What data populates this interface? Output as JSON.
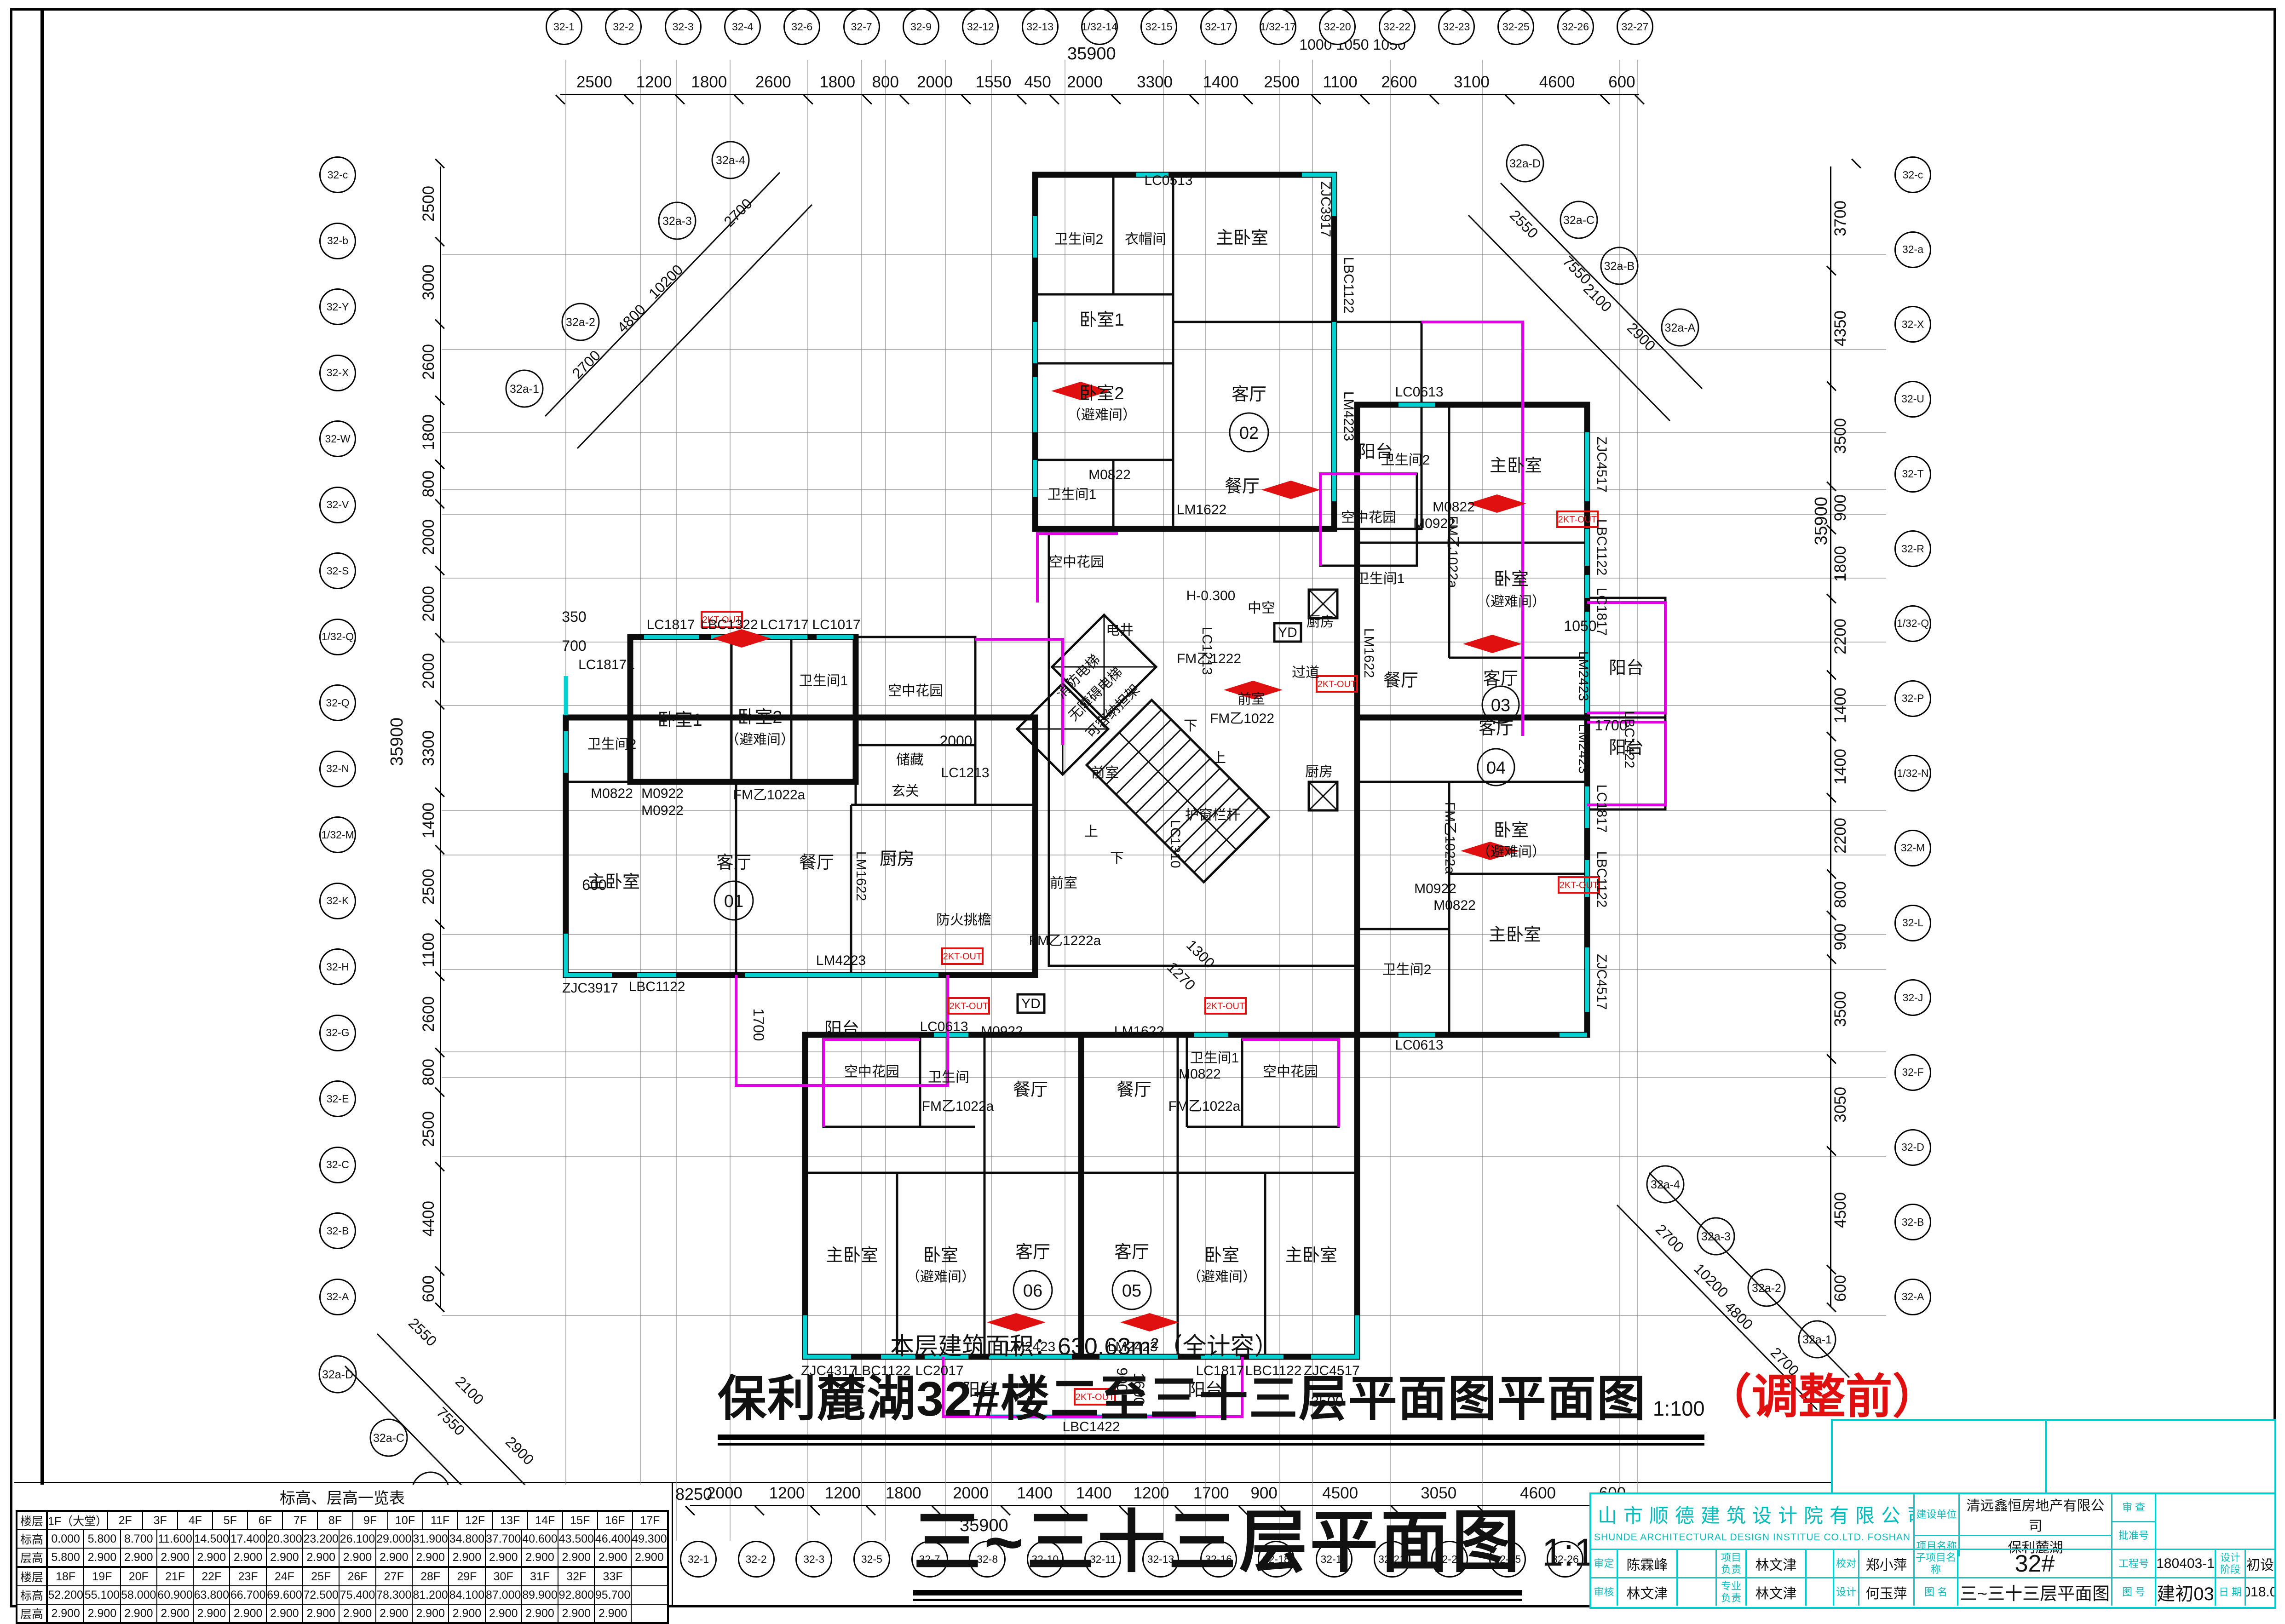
{
  "sheet": {
    "area_note": "本层建筑面积：630.63m²（全计容）",
    "main_title": "保利麓湖32#楼二至三十三层平面图平面图",
    "main_scale": "1:100",
    "revision_note": "（调整前）",
    "drawing_title": "三~三十三层平面图",
    "drawing_scale": "1:100"
  },
  "dims": {
    "top": {
      "total": "35900",
      "segs": [
        "2500",
        "1200",
        "1800",
        "2600",
        "1800",
        "800",
        "2000",
        "1550",
        "450",
        "2000",
        "3300",
        "1400",
        "2500",
        "1100",
        "2600",
        "3100",
        "4600",
        "600"
      ]
    },
    "bottom": {
      "total": "35900",
      "left_note": "8250",
      "segs": [
        "2000",
        "1200",
        "1200",
        "1800",
        "2000",
        "1400",
        "1400",
        "1200",
        "1700",
        "900",
        "4500",
        "3050",
        "4600",
        "600"
      ]
    },
    "left": {
      "total": "35900",
      "segs": [
        "2500",
        "3000",
        "2600",
        "1800",
        "800",
        "2000",
        "2000",
        "2000",
        "3300",
        "1400",
        "2500",
        "1100",
        "2600",
        "800",
        "2500",
        "4400",
        "600"
      ]
    },
    "right": {
      "total": "35900",
      "segs": [
        "3700",
        "4350",
        "3500",
        "900",
        "1800",
        "2200",
        "1400",
        "1400",
        "2200",
        "800",
        "900",
        "3500",
        "3050",
        "4500",
        "600"
      ]
    }
  },
  "axes": {
    "top": [
      "32-1",
      "32-2",
      "32-3",
      "32-4",
      "32-6",
      "32-7",
      "32-9",
      "32-12",
      "32-13",
      "1/32-14",
      "32-15",
      "32-17",
      "1/32-17",
      "32-20",
      "32-22",
      "32-23",
      "32-25",
      "32-26",
      "32-27"
    ],
    "bottom": [
      "32-1",
      "32-2",
      "32-3",
      "32-5",
      "32-7",
      "32-8",
      "32-10",
      "32-11",
      "32-13",
      "32-16",
      "32-18",
      "32-19",
      "32-21",
      "32-24",
      "32-25",
      "32-26",
      "32-27"
    ],
    "left": [
      "32-c",
      "32-b",
      "32-Y",
      "32-X",
      "32-W",
      "32-V",
      "32-S",
      "1/32-Q",
      "32-Q",
      "32-N",
      "1/32-M",
      "32-K",
      "32-H",
      "32-G",
      "32-E",
      "32-C",
      "32-B",
      "32-A"
    ],
    "right": [
      "32-c",
      "32-a",
      "32-X",
      "32-U",
      "32-T",
      "32-R",
      "1/32-Q",
      "32-P",
      "1/32-N",
      "32-M",
      "32-L",
      "32-J",
      "32-F",
      "32-D",
      "32-B",
      "32-A"
    ],
    "corner_tl": {
      "b1": "32a-1",
      "b2": "32a-2",
      "b3": "32a-3",
      "b4": "32a-4",
      "d1": "2700",
      "d2": "4800",
      "d3": "10200",
      "d4": "2700"
    },
    "corner_tr": {
      "b1": "32a-D",
      "b2": "32a-C",
      "b3": "32a-B",
      "b4": "32a-A",
      "d1": "2550",
      "d2": "7550",
      "d3": "2100",
      "d4": "2900"
    },
    "corner_bl": {
      "b1": "32a-D",
      "b2": "32a-C",
      "b3": "32a-B",
      "b4": "32a-A",
      "d1": "2550",
      "d2": "2100",
      "d3": "7550",
      "d4": "2900"
    },
    "corner_br": {
      "b1": "32a-4",
      "b2": "32a-3",
      "b3": "32a-2",
      "b4": "32a-1",
      "d1": "2700",
      "d2": "10200",
      "d3": "4800",
      "d4": "2700"
    }
  },
  "labels": {
    "master": "主卧室",
    "bed1": "卧室1",
    "bed2": "卧室2",
    "bed": "卧室",
    "refuge": "（避难间）",
    "bath1": "卫生间1",
    "bath2": "卫生间2",
    "bath": "卫生间",
    "living": "客厅",
    "dining": "餐厅",
    "kitchen": "厨房",
    "balcony": "阳台",
    "skygarden": "空中花园",
    "foyer": "玄关",
    "storage": "储藏",
    "wardrobe": "衣帽间",
    "corridor": "过道",
    "lobby": "前室",
    "shaft": "电井",
    "fire_elev": "消防电梯",
    "acc_elev": "无障碍电梯",
    "stretcher": "可容纳担架",
    "mid_void": "中空",
    "level": "H-0.300",
    "rail": "护窗栏杆",
    "eave": "防火挑檐",
    "up": "上",
    "down": "下"
  },
  "units": {
    "u01": "01",
    "u02": "02",
    "u03": "03",
    "u04": "04",
    "u05": "05",
    "u06": "06"
  },
  "codes": {
    "lc1817": "LC1817",
    "lc1817a": "LC1817a",
    "lbc1322": "LBC1322",
    "lc1717": "LC1717",
    "lc1017": "LC1017",
    "lc1213": "LC1213",
    "lc1310": "LC1310",
    "lc1013": "LC1013",
    "lc0613": "LC0613",
    "lc0513": "LC0513",
    "lc2017": "LC2017",
    "lbc1122": "LBC1122",
    "lbc1422": "LBC1422",
    "lm4223": "LM4223",
    "lm2423": "LM2423",
    "lm1622": "LM1622",
    "m0822": "M0822",
    "m0922": "M0922",
    "fmy1022": "FM乙1022",
    "fmy1022a": "FM乙1022a",
    "fmy1222": "FM乙1222",
    "fmy1222a": "FM乙1222a",
    "zjc3917": "ZJC3917",
    "zjc4317": "ZJC4317",
    "zjc4517": "ZJC4517",
    "yd": "YD",
    "kt": "2KT-OUT"
  },
  "misc": {
    "d350": "350",
    "d700": "700",
    "d600": "600",
    "d1050": "1050",
    "d1700": "1700",
    "d2000": "2000",
    "d900": "900",
    "d1600": "1600",
    "d3500": "3500",
    "d1300": "1300",
    "d1270": "1270",
    "top_small": "1000  1050  1050"
  },
  "table": {
    "title": "标高、层高一览表",
    "row_headers": [
      "楼层",
      "标高",
      "层高"
    ],
    "floors1": [
      "1F（大堂）",
      "2F",
      "3F",
      "4F",
      "5F",
      "6F",
      "7F",
      "8F",
      "9F",
      "10F",
      "11F",
      "12F",
      "13F",
      "14F",
      "15F",
      "16F",
      "17F"
    ],
    "elev1": [
      "0.000",
      "5.800",
      "8.700",
      "11.600",
      "14.500",
      "17.400",
      "20.300",
      "23.200",
      "26.100",
      "29.000",
      "31.900",
      "34.800",
      "37.700",
      "40.600",
      "43.500",
      "46.400",
      "49.300"
    ],
    "height1": [
      "5.800",
      "2.900",
      "2.900",
      "2.900",
      "2.900",
      "2.900",
      "2.900",
      "2.900",
      "2.900",
      "2.900",
      "2.900",
      "2.900",
      "2.900",
      "2.900",
      "2.900",
      "2.900",
      "2.900"
    ],
    "floors2": [
      "18F",
      "19F",
      "20F",
      "21F",
      "22F",
      "23F",
      "24F",
      "25F",
      "26F",
      "27F",
      "28F",
      "29F",
      "30F",
      "31F",
      "32F",
      "33F",
      ""
    ],
    "elev2": [
      "52.200",
      "55.100",
      "58.000",
      "60.900",
      "63.800",
      "66.700",
      "69.600",
      "72.500",
      "75.400",
      "78.300",
      "81.200",
      "84.100",
      "87.000",
      "89.900",
      "92.800",
      "95.700",
      ""
    ],
    "height2": [
      "2.900",
      "2.900",
      "2.900",
      "2.900",
      "2.900",
      "2.900",
      "2.900",
      "2.900",
      "2.900",
      "2.900",
      "2.900",
      "2.900",
      "2.900",
      "2.900",
      "2.900",
      "2.900",
      ""
    ]
  },
  "titleblock": {
    "company": "佛山市顺德建筑设计院有限公司",
    "company_en": "SHUNDE ARCHITECTURAL DESIGN INSTITUE CO.LTD. FOSHAN",
    "owner_l": "建设单位",
    "owner_v": "清远鑫恒房地产有限公司",
    "project_l": "项目名称",
    "project_v": "保利麓湖",
    "review_l": "审 查",
    "approve_l": "批准号",
    "shending_l": "审定",
    "shending_v": "陈霖峰",
    "pm_l": "项目负责",
    "pm_v": "林文津",
    "check_l": "校对",
    "check_v": "郑小萍",
    "sub_l": "子项目名称",
    "sub_v": "32#",
    "jobno_l": "工程号",
    "jobno_v": "180403-1",
    "stage_l": "设计阶段",
    "stage_v": "初设",
    "shenhe_l": "审核",
    "shenhe_v": "林文津",
    "lead_l": "专业负责",
    "lead_v": "林文津",
    "design_l": "设计",
    "design_v": "何玉萍",
    "name_l": "图 名",
    "name_v": "三~三十三层平面图",
    "no_l": "图 号",
    "no_v": "建初03",
    "date_l": "日 期",
    "date_v": "2018.04"
  }
}
